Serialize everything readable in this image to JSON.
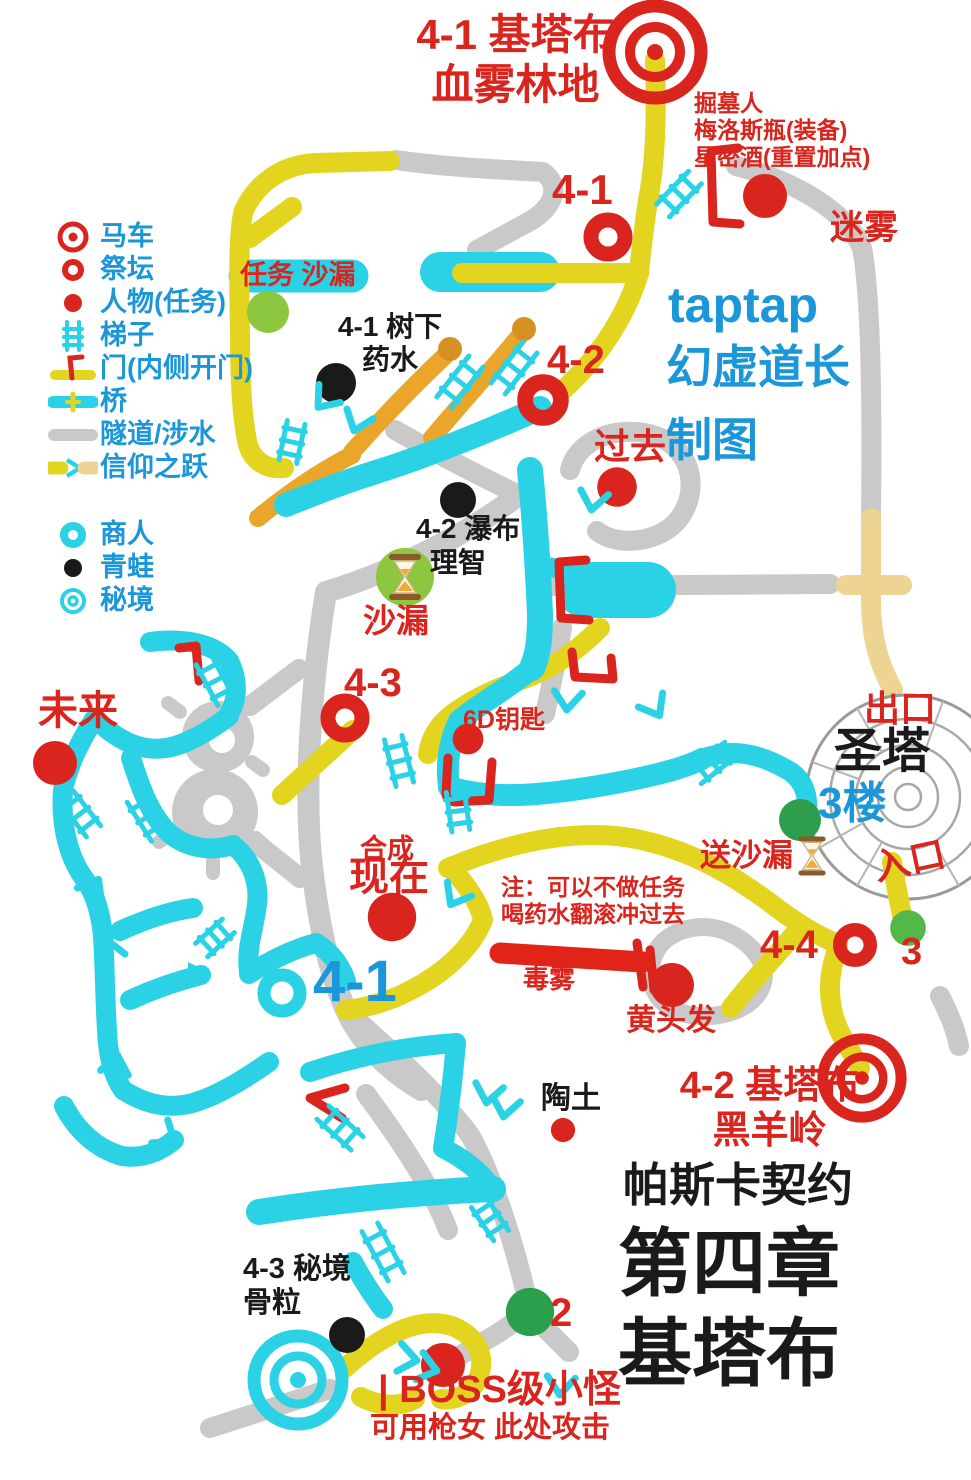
{
  "colors": {
    "red": "#d9251d",
    "blue": "#1b96d9",
    "black": "#1a1a1a",
    "yellow": "#e3d51f",
    "orange": "#e9a62a",
    "tan": "#edd492",
    "cyan": "#2bd2e6",
    "gray": "#c9c9c9",
    "light_green": "#8dc63f",
    "dark_green": "#2f9e4c",
    "mid_green": "#54b848",
    "poison_red": "#e02418"
  },
  "legend": {
    "groups": [
      {
        "items": [
          {
            "icon": "carriage-target-icon",
            "label": "马车"
          },
          {
            "icon": "altar-ring-icon",
            "label": "祭坛"
          },
          {
            "icon": "person-dot-icon",
            "label": "人物(任务)"
          },
          {
            "icon": "ladder-icon",
            "label": "梯子"
          },
          {
            "icon": "door-icon",
            "label": "门(内侧开门)"
          },
          {
            "icon": "bridge-icon",
            "label": "桥"
          },
          {
            "icon": "tunnel-icon",
            "label": "隧道/涉水"
          },
          {
            "icon": "leap-of-faith-icon",
            "label": "信仰之跃"
          }
        ]
      },
      {
        "items": [
          {
            "icon": "merchant-ring-icon",
            "label": "商人"
          },
          {
            "icon": "frog-dot-icon",
            "label": "青蛙"
          },
          {
            "icon": "secret-realm-icon",
            "label": "秘境"
          }
        ]
      }
    ]
  },
  "labels": [
    {
      "id": "area-title-41",
      "text": "4-1 基塔布\n血雾林地",
      "x": 413,
      "y": 10,
      "size": 42,
      "color": "red",
      "align": "center",
      "w": 205
    },
    {
      "id": "gravedigger-note",
      "text": "掘墓人\n梅洛斯瓶(装备)\n星密酒(重置加点)",
      "x": 694,
      "y": 90,
      "size": 23,
      "color": "red"
    },
    {
      "id": "altar-41-label",
      "text": "4-1",
      "x": 552,
      "y": 165,
      "size": 42,
      "color": "red"
    },
    {
      "id": "mist-label",
      "text": "迷雾",
      "x": 830,
      "y": 208,
      "size": 34,
      "color": "red"
    },
    {
      "id": "quest-hourglass-label",
      "text": "任务 沙漏",
      "x": 240,
      "y": 260,
      "size": 27,
      "color": "red"
    },
    {
      "id": "tree-potion-note",
      "text": "4-1 树下\n药水",
      "x": 330,
      "y": 310,
      "size": 28,
      "color": "black",
      "align": "center",
      "w": 120
    },
    {
      "id": "altar-42-label",
      "text": "4-2",
      "x": 547,
      "y": 337,
      "size": 40,
      "color": "red"
    },
    {
      "id": "credit-taptap",
      "text": "taptap",
      "x": 668,
      "y": 276,
      "size": 50,
      "color": "blue"
    },
    {
      "id": "credit-author",
      "text": "幻虚道长",
      "x": 666,
      "y": 340,
      "size": 46,
      "color": "blue"
    },
    {
      "id": "credit-mapped-by",
      "text": "制图",
      "x": 666,
      "y": 413,
      "size": 46,
      "color": "blue"
    },
    {
      "id": "past-label",
      "text": "过去",
      "x": 594,
      "y": 426,
      "size": 36,
      "color": "red"
    },
    {
      "id": "waterfall-note",
      "text": "4-2 瀑布",
      "x": 416,
      "y": 512,
      "size": 28,
      "color": "black"
    },
    {
      "id": "sanity-note",
      "text": "理智",
      "x": 430,
      "y": 546,
      "size": 28,
      "color": "black"
    },
    {
      "id": "hourglass-label",
      "text": "沙漏",
      "x": 363,
      "y": 602,
      "size": 33,
      "color": "red"
    },
    {
      "id": "future-label",
      "text": "未来",
      "x": 38,
      "y": 688,
      "size": 40,
      "color": "red"
    },
    {
      "id": "altar-43-label",
      "text": "4-3",
      "x": 344,
      "y": 660,
      "size": 40,
      "color": "red"
    },
    {
      "id": "key-6d-label",
      "text": "6D钥匙",
      "x": 463,
      "y": 706,
      "size": 25,
      "color": "red"
    },
    {
      "id": "exit-label",
      "text": "出口",
      "x": 864,
      "y": 688,
      "size": 36,
      "color": "red"
    },
    {
      "id": "holy-tower-label",
      "text": "圣塔",
      "x": 834,
      "y": 724,
      "size": 48,
      "color": "black"
    },
    {
      "id": "floor-3-label",
      "text": "3楼",
      "x": 818,
      "y": 778,
      "size": 44,
      "color": "blue"
    },
    {
      "id": "deliver-hourglass-label",
      "text": "送沙漏",
      "x": 700,
      "y": 838,
      "size": 31,
      "color": "red"
    },
    {
      "id": "entrance-label",
      "text": "入口",
      "x": 870,
      "y": 848,
      "size": 36,
      "color": "red",
      "rot": -12
    },
    {
      "id": "synthesis-label",
      "text": "合成",
      "x": 360,
      "y": 834,
      "size": 27,
      "color": "red"
    },
    {
      "id": "present-label",
      "text": "现在",
      "x": 349,
      "y": 854,
      "size": 40,
      "color": "red"
    },
    {
      "id": "skip-note",
      "text": "注：可以不做任务\n喝药水翻滚冲过去",
      "x": 501,
      "y": 874,
      "size": 23,
      "color": "red"
    },
    {
      "id": "altar-44-label",
      "text": "4-4",
      "x": 760,
      "y": 922,
      "size": 40,
      "color": "red"
    },
    {
      "id": "num-3-label",
      "text": "3",
      "x": 901,
      "y": 930,
      "size": 38,
      "color": "red"
    },
    {
      "id": "poison-mist-label",
      "text": "毒雾",
      "x": 523,
      "y": 964,
      "size": 26,
      "color": "red"
    },
    {
      "id": "yellow-hair-label",
      "text": "黄头发",
      "x": 626,
      "y": 1003,
      "size": 30,
      "color": "red"
    },
    {
      "id": "area-41-blue-label",
      "text": "4-1",
      "x": 313,
      "y": 948,
      "size": 58,
      "color": "blue"
    },
    {
      "id": "clay-label",
      "text": "陶土",
      "x": 541,
      "y": 1081,
      "size": 30,
      "color": "black"
    },
    {
      "id": "area-title-42",
      "text": "4-2 基塔布\n黑羊岭",
      "x": 642,
      "y": 1064,
      "size": 38,
      "color": "red",
      "align": "center",
      "w": 255
    },
    {
      "id": "game-title",
      "text": "帕斯卡契约",
      "x": 623,
      "y": 1158,
      "size": 46,
      "color": "black"
    },
    {
      "id": "chapter-title",
      "text": "第四章",
      "x": 618,
      "y": 1220,
      "size": 74,
      "color": "black"
    },
    {
      "id": "chapter-area-title",
      "text": "基塔布",
      "x": 618,
      "y": 1310,
      "size": 74,
      "color": "black"
    },
    {
      "id": "secret-realm-note",
      "text": "4-3 秘境\n骨粒",
      "x": 243,
      "y": 1252,
      "size": 29,
      "color": "black"
    },
    {
      "id": "num-2-label",
      "text": "2",
      "x": 550,
      "y": 1290,
      "size": 40,
      "color": "red"
    },
    {
      "id": "boss-label",
      "text": "| BOSS级小怪",
      "x": 378,
      "y": 1368,
      "size": 38,
      "color": "red"
    },
    {
      "id": "boss-tip-label",
      "text": "可用枪女 此处攻击",
      "x": 370,
      "y": 1411,
      "size": 29,
      "color": "red"
    }
  ],
  "markers": [
    {
      "kind": "carriage-target",
      "x": 655,
      "y": 52,
      "s": 1
    },
    {
      "kind": "carriage-target",
      "x": 862,
      "y": 1078,
      "s": 0.85
    },
    {
      "kind": "secret-realm-target",
      "x": 298,
      "y": 1380,
      "s": 1
    },
    {
      "kind": "altar-ring",
      "x": 608,
      "y": 237,
      "s": 1
    },
    {
      "kind": "altar-ring",
      "x": 543,
      "y": 400,
      "s": 1.05
    },
    {
      "kind": "altar-ring",
      "x": 345,
      "y": 718,
      "s": 1
    },
    {
      "kind": "altar-ring",
      "x": 855,
      "y": 945,
      "s": 0.9
    },
    {
      "kind": "person-dot",
      "x": 765,
      "y": 196,
      "s": 1
    },
    {
      "kind": "person-dot",
      "x": 617,
      "y": 487,
      "s": 0.9
    },
    {
      "kind": "person-dot",
      "x": 55,
      "y": 763,
      "s": 1
    },
    {
      "kind": "person-dot",
      "x": 468,
      "y": 739,
      "s": 0.7
    },
    {
      "kind": "person-dot",
      "x": 392,
      "y": 917,
      "s": 1.1
    },
    {
      "kind": "person-dot",
      "x": 672,
      "y": 985,
      "s": 1
    },
    {
      "kind": "person-dot",
      "x": 563,
      "y": 1130,
      "s": 0.55
    },
    {
      "kind": "person-dot",
      "x": 443,
      "y": 1365,
      "s": 1
    },
    {
      "kind": "frog-dot",
      "x": 336,
      "y": 383,
      "s": 1
    },
    {
      "kind": "frog-dot",
      "x": 458,
      "y": 500,
      "s": 0.9
    },
    {
      "kind": "frog-dot",
      "x": 347,
      "y": 1335,
      "s": 0.9
    },
    {
      "kind": "green-dot",
      "x": 268,
      "y": 312,
      "s": 1,
      "color": "#8dc63f"
    },
    {
      "kind": "green-dot",
      "x": 800,
      "y": 820,
      "s": 1,
      "color": "#2f9e4c"
    },
    {
      "kind": "green-dot",
      "x": 908,
      "y": 928,
      "s": 0.85,
      "color": "#54b848"
    },
    {
      "kind": "green-dot",
      "x": 530,
      "y": 1312,
      "s": 1.15,
      "color": "#2aa04d"
    },
    {
      "kind": "merchant-ring",
      "x": 282,
      "y": 993,
      "s": 1
    },
    {
      "kind": "hourglass",
      "x": 405,
      "y": 577,
      "s": 1,
      "badge": true
    },
    {
      "kind": "hourglass",
      "x": 812,
      "y": 856,
      "s": 0.85,
      "badge": false
    },
    {
      "kind": "ladder",
      "x": 679,
      "y": 194,
      "a": -46,
      "len": 46
    },
    {
      "kind": "ladder",
      "x": 460,
      "y": 382,
      "a": -52,
      "len": 52
    },
    {
      "kind": "ladder",
      "x": 514,
      "y": 368,
      "a": -52,
      "len": 52
    },
    {
      "kind": "ladder",
      "x": 292,
      "y": 442,
      "a": -78,
      "len": 40
    },
    {
      "kind": "ladder",
      "x": 215,
      "y": 681,
      "a": 62,
      "len": 46
    },
    {
      "kind": "ladder",
      "x": 80,
      "y": 814,
      "a": 52,
      "len": 44
    },
    {
      "kind": "ladder",
      "x": 147,
      "y": 817,
      "a": 58,
      "len": 46
    },
    {
      "kind": "ladder",
      "x": 215,
      "y": 938,
      "a": -42,
      "len": 36
    },
    {
      "kind": "ladder",
      "x": 399,
      "y": 761,
      "a": 76,
      "len": 48
    },
    {
      "kind": "ladder",
      "x": 458,
      "y": 811,
      "a": 82,
      "len": 40
    },
    {
      "kind": "ladder",
      "x": 713,
      "y": 763,
      "a": -38,
      "len": 44
    },
    {
      "kind": "ladder",
      "x": 340,
      "y": 1128,
      "a": 42,
      "len": 46
    },
    {
      "kind": "ladder",
      "x": 383,
      "y": 1252,
      "a": 62,
      "len": 56
    },
    {
      "kind": "ladder",
      "x": 490,
      "y": 1219,
      "a": 56,
      "len": 40
    },
    {
      "kind": "arrow",
      "x": 320,
      "y": 405,
      "a": 130,
      "style": "open"
    },
    {
      "kind": "arrow",
      "x": 355,
      "y": 428,
      "a": 110,
      "style": "open"
    },
    {
      "kind": "arrow",
      "x": 452,
      "y": 902,
      "a": 120,
      "style": "open"
    },
    {
      "kind": "arrow",
      "x": 592,
      "y": 507,
      "a": 100,
      "style": "open"
    },
    {
      "kind": "arrow",
      "x": 567,
      "y": 707,
      "a": 95,
      "style": "open"
    },
    {
      "kind": "arrow",
      "x": 658,
      "y": 713,
      "a": 60,
      "style": "open"
    },
    {
      "kind": "arrow",
      "x": 97,
      "y": 882,
      "a": -60,
      "style": "open"
    },
    {
      "kind": "arrow",
      "x": 110,
      "y": 940,
      "a": 180,
      "style": "open"
    },
    {
      "kind": "arrow",
      "x": 204,
      "y": 973,
      "a": 0,
      "style": "solid"
    },
    {
      "kind": "arrow",
      "x": 117,
      "y": 1058,
      "a": -80,
      "style": "open"
    },
    {
      "kind": "arrow",
      "x": 172,
      "y": 1140,
      "a": 35,
      "style": "open"
    },
    {
      "kind": "arrow",
      "x": 487,
      "y": 1100,
      "a": 100,
      "style": "open"
    },
    {
      "kind": "arrow",
      "x": 504,
      "y": 1114,
      "a": 100,
      "style": "open"
    },
    {
      "kind": "arrow",
      "x": 414,
      "y": 1360,
      "a": 10,
      "style": "open"
    },
    {
      "kind": "arrow",
      "x": 434,
      "y": 1370,
      "a": 15,
      "style": "open"
    },
    {
      "kind": "arrow",
      "x": 560,
      "y": 1392,
      "a": 95,
      "style": "open"
    }
  ]
}
